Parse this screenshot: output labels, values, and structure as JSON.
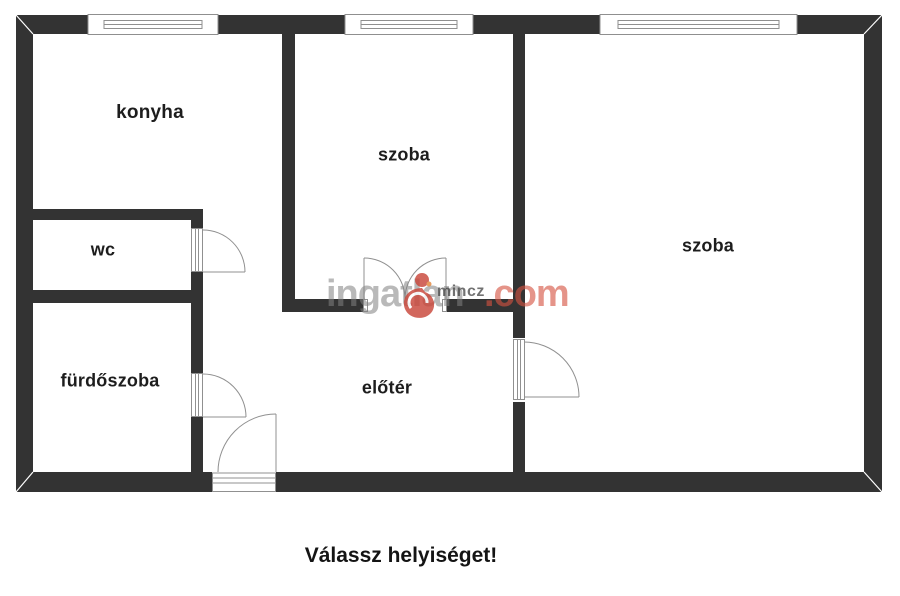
{
  "plan": {
    "rooms": [
      {
        "id": "konyha",
        "label": "konyha"
      },
      {
        "id": "szoba-kozep",
        "label": "szoba"
      },
      {
        "id": "szoba-jobb",
        "label": "szoba"
      },
      {
        "id": "wc",
        "label": "wc"
      },
      {
        "id": "furdoszoba",
        "label": "fürdőszoba"
      },
      {
        "id": "eloter",
        "label": "előtér"
      }
    ]
  },
  "watermark": {
    "brand": "ingatlan",
    "suffix": ".com",
    "overlay": "mincz",
    "logo": "ingatlan-com-figure"
  },
  "footer": {
    "prompt": "Válassz helyiséget!"
  },
  "colors": {
    "wall": "#333333",
    "symbol_line": "#8f8f8f",
    "label_text": "#1d1d1d",
    "watermark_grey": "#808080",
    "watermark_red": "#d5523f",
    "logo_red": "#c9463a"
  }
}
